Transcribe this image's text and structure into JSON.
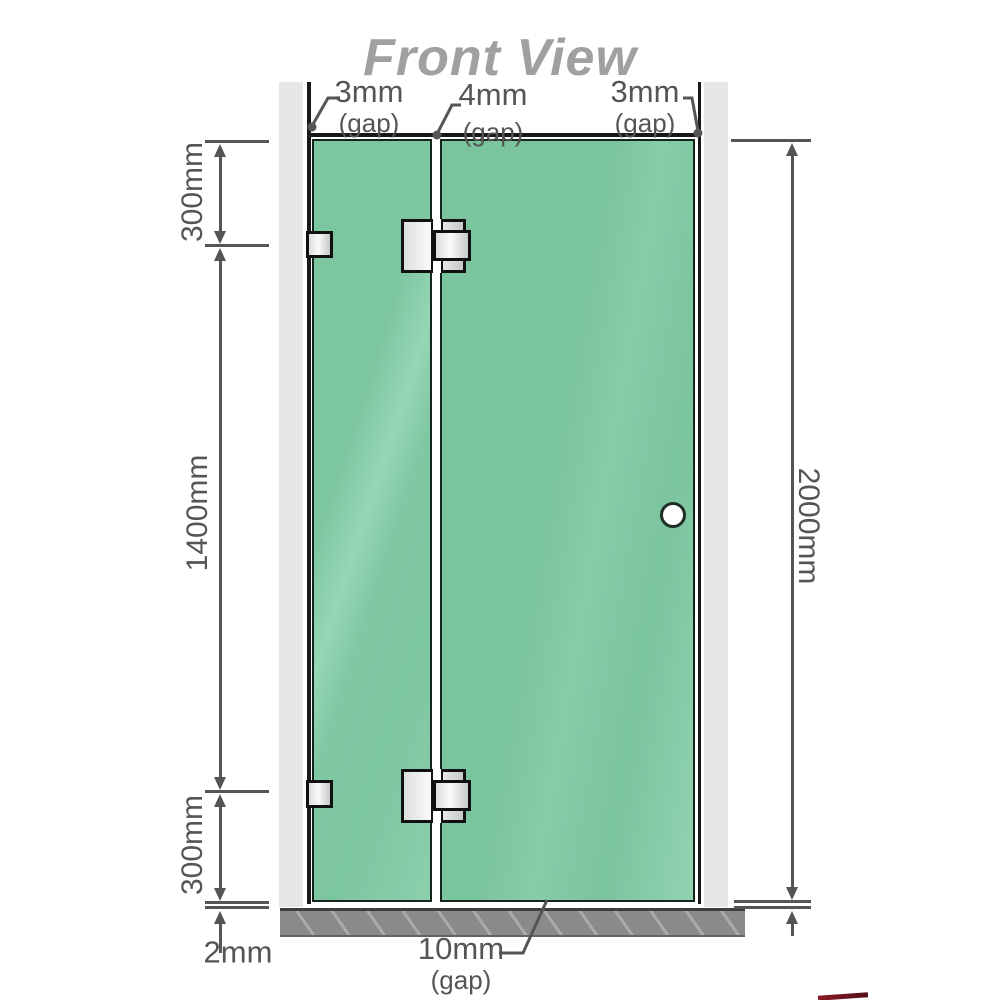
{
  "title": "Front View",
  "dimensions": {
    "top_left_gap": {
      "value": "3mm",
      "unit": "(gap)"
    },
    "top_center_gap": {
      "value": "4mm",
      "unit": "(gap)"
    },
    "top_right_gap": {
      "value": "3mm",
      "unit": "(gap)"
    },
    "bottom_door_gap": {
      "value": "10mm",
      "unit": "(gap)"
    },
    "left_top_segment": "300mm",
    "left_middle_segment": "1400mm",
    "left_bottom_segment": "300mm",
    "right_total_height": "2000mm",
    "floor_clearance": "2mm"
  },
  "colors": {
    "glass": "#7cc6a0",
    "wall": "#e7e7e7",
    "floor": "#8a8a8a",
    "outline": "#181818",
    "dimension_lines": "#555555",
    "title_text": "#a0a0a0",
    "logo_accent": "#8c1a26"
  }
}
